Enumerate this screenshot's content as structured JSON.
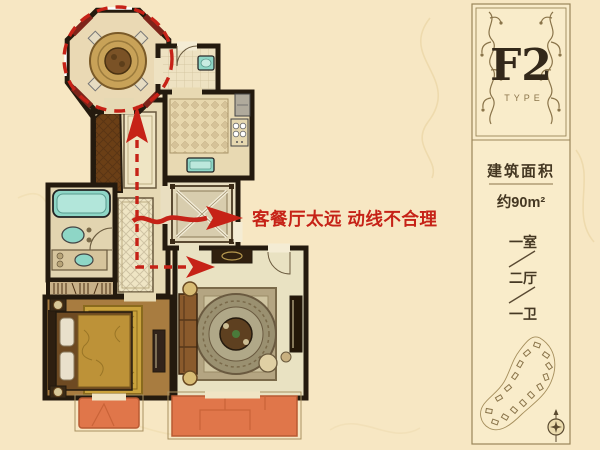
{
  "annotation": {
    "text": "客餐厅太远 动线不合理"
  },
  "panel": {
    "type_code": "F2",
    "type_label": "TYPE",
    "area_label": "建筑面积",
    "area_value": "约90m²",
    "rooms": [
      "一室",
      "二厅",
      "一卫"
    ]
  },
  "colors": {
    "background": "#f7e7c3",
    "wall": "#241a0e",
    "floor_light": "#e9dcba",
    "balcony_orange": "#e0764a",
    "fixture_teal": "#8ed6c6",
    "wood_brown": "#6b3f16",
    "rug_gold": "#c9a23c",
    "annotation_red": "#c62217",
    "panel_line": "#9a8659",
    "panel_text": "#453823"
  }
}
